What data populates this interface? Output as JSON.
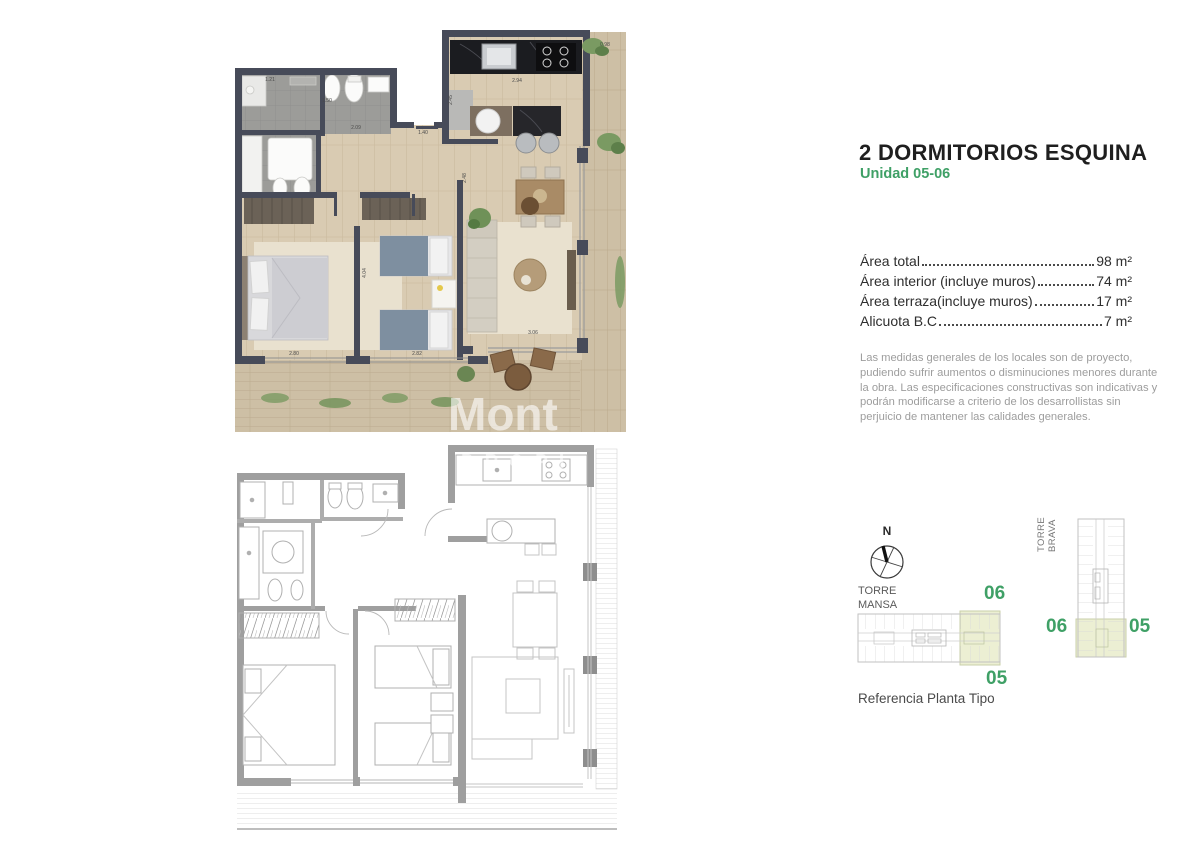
{
  "header": {
    "title": "2 DORMITORIOS ESQUINA",
    "subtitle": "Unidad 05-06"
  },
  "areas": {
    "rows": [
      {
        "label": "Área total",
        "value": "98 m²"
      },
      {
        "label": "Área interior (incluye muros)",
        "value": "74 m²"
      },
      {
        "label": "Área terraza(incluye muros)",
        "value": "17 m²"
      },
      {
        "label": "Alicuota B.C",
        "value": "7 m²"
      }
    ]
  },
  "disclaimer": "Las medidas generales de los locales son de proyecto, pudiendo sufrir aumentos o disminuciones menores durante la obra. Las especificaciones constructivas son indicativas y podrán modificarse a criterio de los desarrollistas sin perjuicio de mantener las calidades generales.",
  "reference": {
    "compass_n": "N",
    "torre_mansa_label": "TORRE MANSA",
    "torre_brava_label": "TORRE BRAVA",
    "mansa_unit_top": "06",
    "mansa_unit_bottom": "05",
    "brava_unit_left": "06",
    "brava_unit_right": "05",
    "caption": "Referencia Planta Tipo"
  },
  "plans": {
    "rendered": {
      "watermark": "Mont",
      "dims": [
        "1.21",
        "1.50",
        "2.09",
        "1.40",
        "2.45",
        "2.94",
        "0.98",
        "2.80",
        "2.82",
        "3.06",
        "4.04",
        "2.48"
      ]
    },
    "technical": {
      "watermark": "PROPI"
    }
  },
  "colors": {
    "accent_green": "#3fa066",
    "highlight": "#ecefd3",
    "wall_dark": "#474b59",
    "plan_gray": "#9f9f9f"
  }
}
